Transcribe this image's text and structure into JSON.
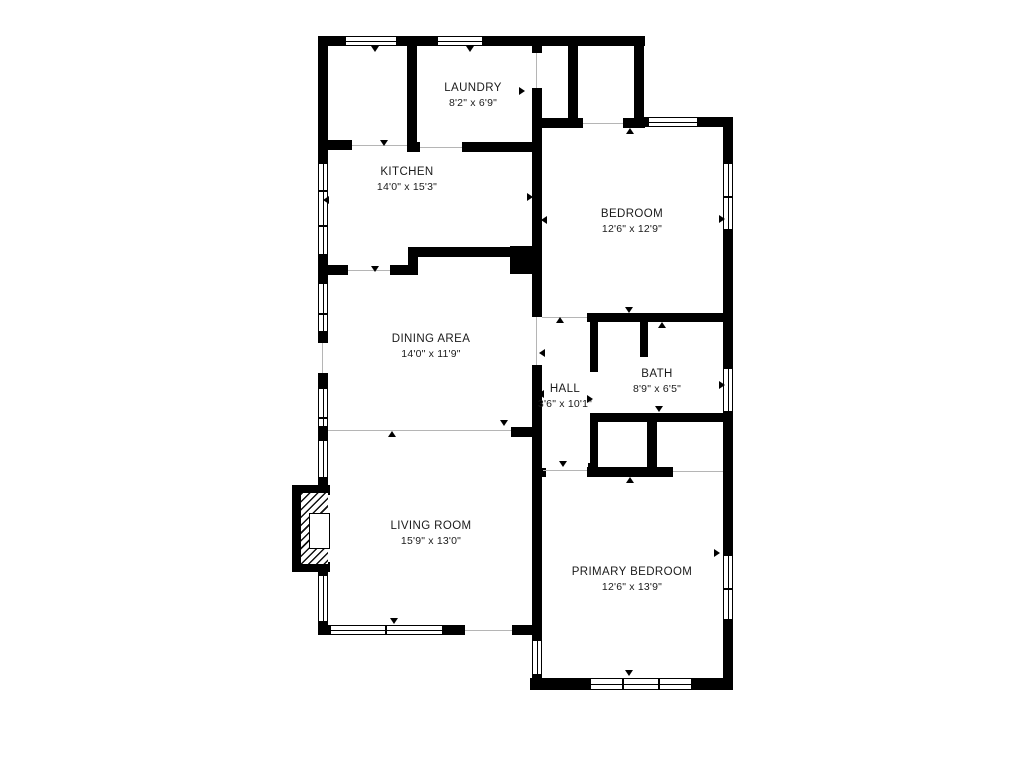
{
  "plan": {
    "background_color": "#ffffff",
    "wall_color": "#000000",
    "text_color": "#1b1b1b"
  },
  "rooms": [
    {
      "id": "laundry",
      "name": "LAUNDRY",
      "dimensions": "8'2\" x 6'9\""
    },
    {
      "id": "kitchen",
      "name": "KITCHEN",
      "dimensions": "14'0\" x 15'3\""
    },
    {
      "id": "bedroom",
      "name": "BEDROOM",
      "dimensions": "12'6\" x 12'9\""
    },
    {
      "id": "dining",
      "name": "DINING AREA",
      "dimensions": "14'0\" x 11'9\""
    },
    {
      "id": "hall",
      "name": "HALL",
      "dimensions": "3'6\" x 10'1\""
    },
    {
      "id": "bath",
      "name": "BATH",
      "dimensions": "8'9\" x 6'5\""
    },
    {
      "id": "living",
      "name": "LIVING ROOM",
      "dimensions": "15'9\" x 13'0\""
    },
    {
      "id": "primary",
      "name": "PRIMARY BEDROOM",
      "dimensions": "12'6\" x 13'9\""
    }
  ]
}
